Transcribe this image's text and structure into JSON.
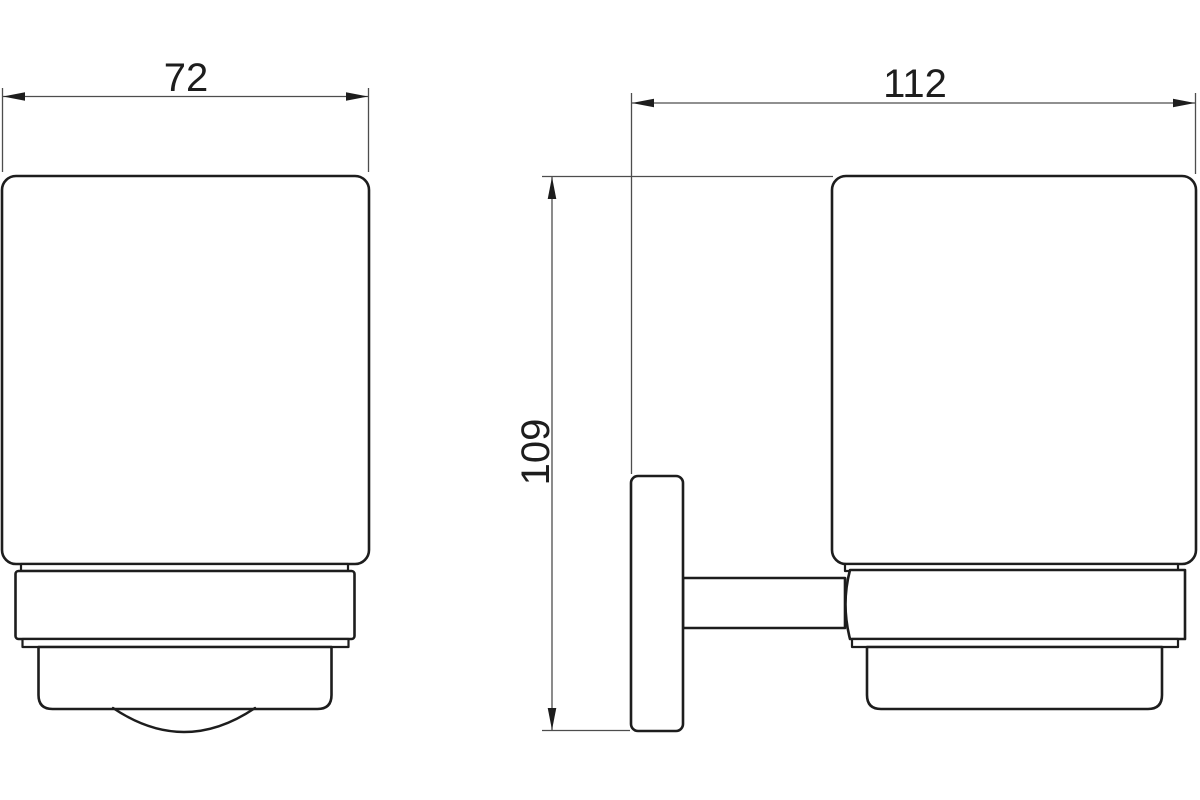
{
  "drawing": {
    "kind": "technical-dimension-drawing",
    "subject": "wall-mounted-tumbler-holder",
    "background_color": "#ffffff",
    "outline_color": "#1d1d1d",
    "dimension_line_color": "#4d4d4d",
    "labels": {
      "front_width": "72",
      "side_width": "112",
      "side_height": "109"
    }
  }
}
